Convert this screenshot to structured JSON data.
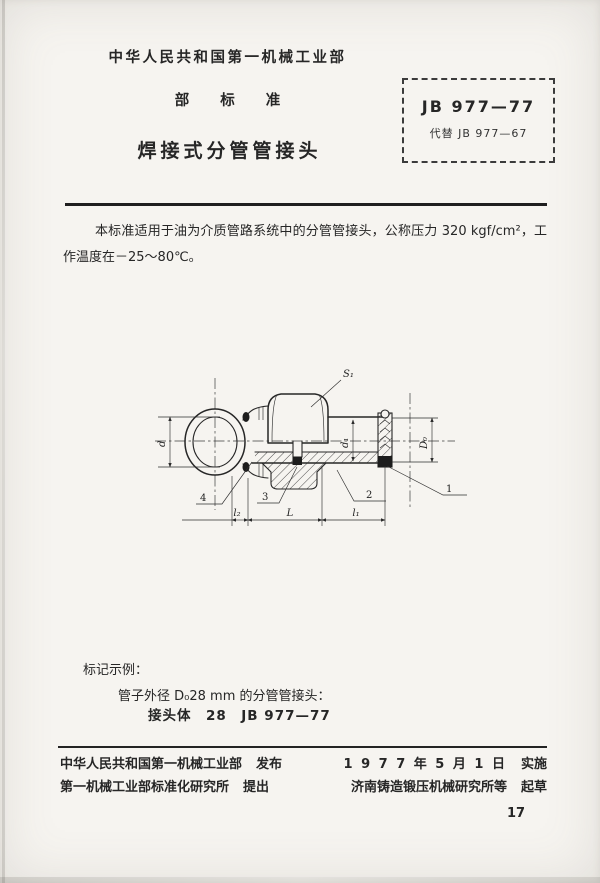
{
  "document": {
    "ministry": "中华人民共和国第一机械工业部",
    "standard_type": "部标准",
    "title": "焊接式分管管接头",
    "stamp": {
      "code": "JB 977—77",
      "replaces": "代替 JB 977—67"
    },
    "scope": "本标准适用于油为介质管路系统中的分管管接头，公称压力 320 kgf/cm²，工作温度在－25～80℃。",
    "marking": {
      "heading": "标记示例：",
      "description": "管子外径 D₀28 mm 的分管管接头：",
      "designation": "接头体　28　JB 977—77"
    },
    "page_number": "17"
  },
  "drawing": {
    "labels": {
      "s1": "S₁",
      "d": "d",
      "d1": "d₁",
      "D0": "D₀",
      "l2": "l₂",
      "L": "L",
      "l1": "l₁",
      "part1": "1",
      "part2": "2",
      "part3": "3",
      "part4": "4"
    }
  },
  "footer": {
    "publisher": "中华人民共和国第一机械工业部",
    "publisher_tag": "发布",
    "date": "1 9 7 7 年 5 月 1 日",
    "date_tag": "实施",
    "proposer": "第一机械工业部标准化研究所",
    "proposer_tag": "提出",
    "drafter": "济南铸造锻压机械研究所等",
    "drafter_tag": "起草"
  },
  "colors": {
    "ink": "#262626",
    "paper": "#f6f4f0"
  }
}
